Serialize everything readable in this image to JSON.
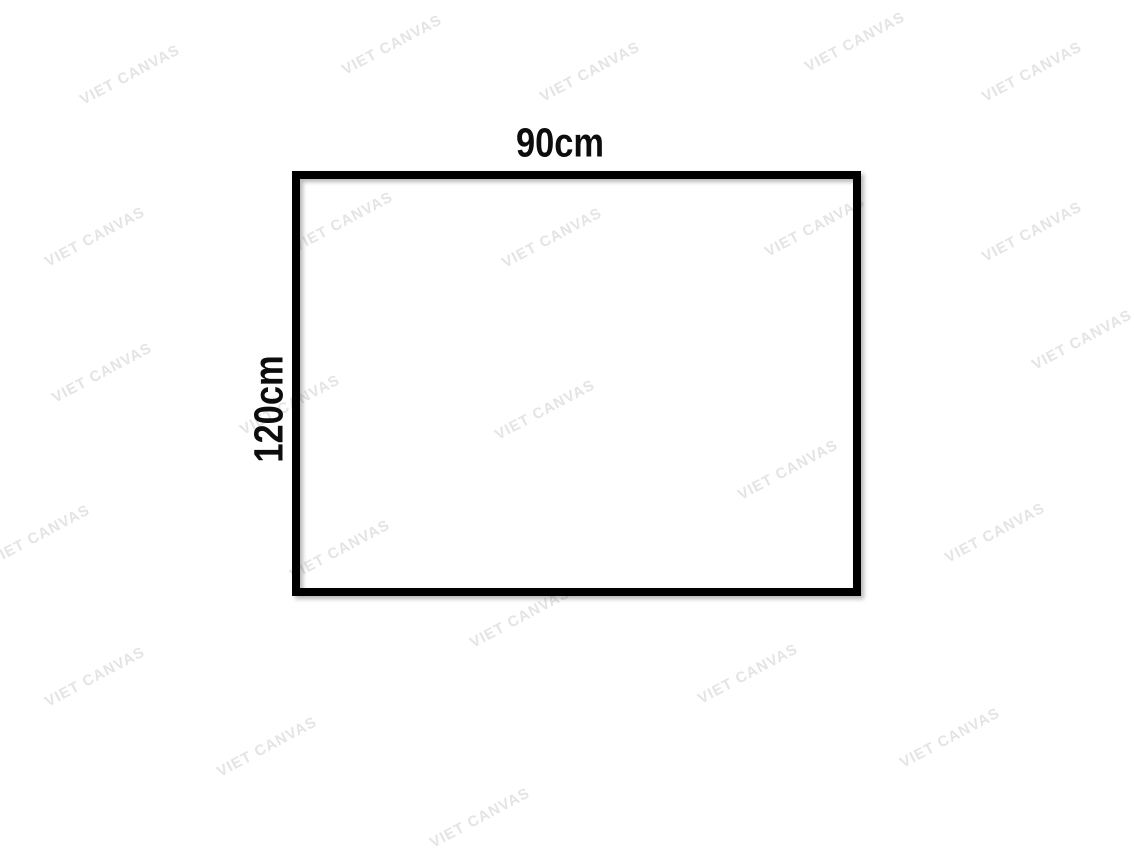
{
  "page": {
    "background_color": "#ffffff"
  },
  "diagram": {
    "width_label": "90cm",
    "height_label": "120cm",
    "frame_border_color": "#000000",
    "label_color": "#0d0d0d"
  },
  "watermark": {
    "text": "VIET CANVAS",
    "color": "#e4e4e4",
    "angle_deg": -28,
    "positions": [
      {
        "x": 130,
        "y": 75
      },
      {
        "x": 392,
        "y": 45
      },
      {
        "x": 590,
        "y": 72
      },
      {
        "x": 855,
        "y": 42
      },
      {
        "x": 1032,
        "y": 72
      },
      {
        "x": 95,
        "y": 237
      },
      {
        "x": 343,
        "y": 222
      },
      {
        "x": 552,
        "y": 238
      },
      {
        "x": 815,
        "y": 227
      },
      {
        "x": 1032,
        "y": 232
      },
      {
        "x": 102,
        "y": 373
      },
      {
        "x": 290,
        "y": 405
      },
      {
        "x": 545,
        "y": 410
      },
      {
        "x": 788,
        "y": 470
      },
      {
        "x": 1082,
        "y": 340
      },
      {
        "x": 40,
        "y": 535
      },
      {
        "x": 340,
        "y": 550
      },
      {
        "x": 520,
        "y": 618
      },
      {
        "x": 995,
        "y": 533
      },
      {
        "x": 95,
        "y": 677
      },
      {
        "x": 748,
        "y": 674
      },
      {
        "x": 267,
        "y": 747
      },
      {
        "x": 950,
        "y": 738
      },
      {
        "x": 480,
        "y": 818
      }
    ]
  }
}
